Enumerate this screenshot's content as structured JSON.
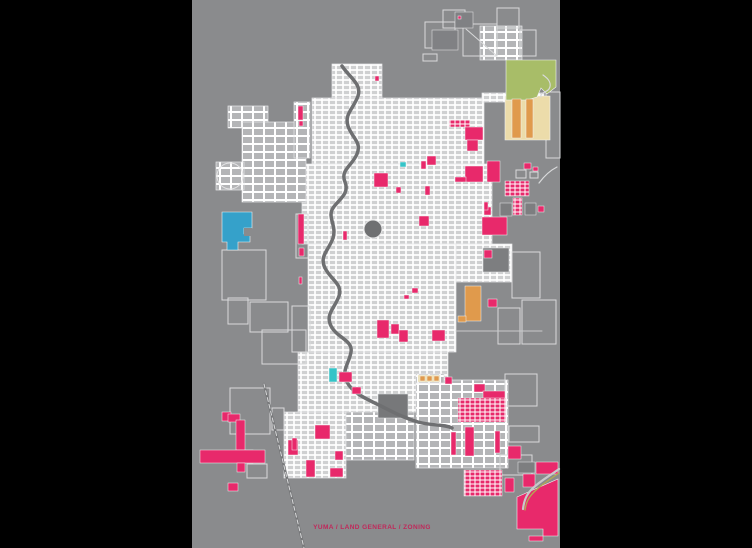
{
  "map": {
    "left": 192,
    "top": 0,
    "width": 368,
    "height": 548,
    "background": "#8a8b8d",
    "frame_color": "#000000",
    "caption": {
      "text": "YUMA / LAND GENERAL / ZONING",
      "x": 372,
      "y": 529,
      "size": 6.5,
      "color": "#c0285a"
    },
    "palette": {
      "pink": "#e8296b",
      "darkpink": "#8c1d47",
      "blue": "#35a1ca",
      "cyan": "#35c4c8",
      "green": "#a8bd68",
      "cream": "#ecdcaa",
      "orange": "#e09a4c",
      "khaki": "#b3ab50",
      "dark1": "#6f7072",
      "dark2": "#77787a",
      "dark3": "#7d7e80",
      "dark4": "#808184",
      "line": "#d9dadb",
      "river": "#6e6f71",
      "road": "#c9cacb",
      "bg": "#8a8b8d"
    },
    "fabric": [
      {
        "r": [
          332,
          64,
          50,
          36
        ],
        "s": "dense"
      },
      {
        "r": [
          312,
          98,
          172,
          66
        ],
        "s": "dense"
      },
      {
        "r": [
          482,
          93,
          62,
          9
        ],
        "s": "dense"
      },
      {
        "r": [
          302,
          164,
          190,
          80
        ],
        "s": "dense"
      },
      {
        "r": [
          456,
          244,
          56,
          38
        ],
        "s": "dense"
      },
      {
        "r": [
          308,
          244,
          148,
          108
        ],
        "s": "dense"
      },
      {
        "r": [
          298,
          352,
          150,
          60
        ],
        "s": "dense"
      },
      {
        "r": [
          284,
          412,
          62,
          66
        ],
        "s": "dense"
      },
      {
        "r": [
          346,
          412,
          68,
          48
        ],
        "s": "medium"
      },
      {
        "r": [
          416,
          380,
          92,
          88
        ],
        "s": "medium"
      },
      {
        "r": [
          480,
          26,
          42,
          34
        ],
        "s": "medium"
      },
      {
        "r": [
          228,
          106,
          40,
          22
        ],
        "s": "medium"
      },
      {
        "r": [
          242,
          122,
          64,
          80
        ],
        "s": "medium"
      },
      {
        "r": [
          216,
          162,
          28,
          28
        ],
        "s": "medium"
      },
      {
        "r": [
          416,
          374,
          28,
          9
        ],
        "s": "medium"
      },
      {
        "r": [
          294,
          102,
          16,
          56
        ],
        "s": "medium"
      }
    ],
    "outlines": [
      [
        425,
        22,
        30,
        26
      ],
      [
        443,
        10,
        22,
        18
      ],
      [
        463,
        24,
        34,
        32
      ],
      [
        497,
        8,
        22,
        20
      ],
      [
        520,
        30,
        16,
        26
      ],
      [
        423,
        54,
        14,
        7
      ],
      [
        222,
        250,
        44,
        50
      ],
      [
        228,
        298,
        20,
        26
      ],
      [
        250,
        302,
        38,
        30
      ],
      [
        262,
        330,
        44,
        34
      ],
      [
        292,
        306,
        18,
        46
      ],
      [
        230,
        388,
        40,
        46
      ],
      [
        272,
        408,
        12,
        22
      ],
      [
        247,
        464,
        20,
        14
      ],
      [
        512,
        252,
        28,
        46
      ],
      [
        498,
        308,
        22,
        36
      ],
      [
        522,
        300,
        34,
        44
      ],
      [
        546,
        92,
        14,
        66
      ],
      [
        505,
        374,
        32,
        32
      ],
      [
        509,
        426,
        30,
        16
      ],
      [
        500,
        455,
        32,
        20
      ],
      [
        296,
        214,
        12,
        44
      ],
      [
        516,
        170,
        10,
        8
      ],
      [
        530,
        172,
        8,
        6
      ]
    ],
    "darks": [
      {
        "r": [
          378,
          394,
          30,
          24
        ],
        "c": "dark2"
      },
      {
        "r": [
          483,
          248,
          26,
          24
        ],
        "c": "dark3"
      },
      {
        "r": [
          518,
          462,
          17,
          11
        ],
        "c": "dark3"
      },
      {
        "r": [
          432,
          30,
          26,
          20
        ],
        "c": "dark4"
      },
      {
        "r": [
          455,
          12,
          18,
          16
        ],
        "c": "dark4"
      },
      {
        "r": [
          500,
          203,
          12,
          13
        ],
        "c": "dark3"
      },
      {
        "r": [
          525,
          203,
          11,
          12
        ],
        "c": "dark3"
      },
      {
        "r": [
          245,
          450,
          8,
          13
        ],
        "c": "darkpink"
      }
    ],
    "circles": [
      {
        "c": [
          373,
          229,
          9
        ],
        "fill": "dark1"
      },
      {
        "c": [
          230,
          176,
          13
        ],
        "fill": "none"
      }
    ],
    "polygons": [
      {
        "p": "505,96 550,96 550,140 505,140",
        "c": "cream"
      },
      {
        "p": "506,60 556,60 556,87 547,94 541,88 537,97 527,100 506,100",
        "c": "green"
      },
      {
        "p": "222,212 252,212 252,228 244,228 244,234 250,234 250,242 238,242 238,250 227,250 227,242 222,242",
        "c": "blue"
      },
      {
        "p": "517,497 558,479 558,536 543,536 543,529 517,529",
        "c": "pink"
      }
    ],
    "parcels": [
      {
        "r": [
          298,
          106,
          5,
          14
        ],
        "c": "pink"
      },
      {
        "r": [
          299,
          121,
          4,
          5
        ],
        "c": "pink"
      },
      {
        "r": [
          449,
          120,
          21,
          7
        ],
        "c": "pinkgrid"
      },
      {
        "r": [
          465,
          127,
          18,
          13
        ],
        "c": "pink"
      },
      {
        "r": [
          467,
          140,
          11,
          11
        ],
        "c": "pink"
      },
      {
        "r": [
          427,
          156,
          9,
          9
        ],
        "c": "pink"
      },
      {
        "r": [
          421,
          161,
          5,
          8
        ],
        "c": "pink"
      },
      {
        "r": [
          465,
          166,
          18,
          16
        ],
        "c": "pink"
      },
      {
        "r": [
          487,
          161,
          13,
          21
        ],
        "c": "pink"
      },
      {
        "r": [
          524,
          163,
          7,
          6
        ],
        "c": "pink"
      },
      {
        "r": [
          533,
          167,
          5,
          4
        ],
        "c": "pink"
      },
      {
        "r": [
          455,
          177,
          11,
          5
        ],
        "c": "pink"
      },
      {
        "r": [
          374,
          173,
          14,
          14
        ],
        "c": "pink"
      },
      {
        "r": [
          396,
          187,
          5,
          6
        ],
        "c": "pink"
      },
      {
        "r": [
          425,
          186,
          5,
          9
        ],
        "c": "pink"
      },
      {
        "r": [
          375,
          76,
          4,
          5
        ],
        "c": "pink"
      },
      {
        "r": [
          458,
          16,
          3,
          3
        ],
        "c": "pink"
      },
      {
        "r": [
          505,
          181,
          24,
          15
        ],
        "c": "pinkgrid"
      },
      {
        "r": [
          513,
          198,
          9,
          17
        ],
        "c": "pinkgrid"
      },
      {
        "r": [
          419,
          216,
          10,
          10
        ],
        "c": "pink"
      },
      {
        "r": [
          484,
          207,
          7,
          8
        ],
        "c": "pink"
      },
      {
        "r": [
          482,
          217,
          25,
          18
        ],
        "c": "pink"
      },
      {
        "r": [
          538,
          206,
          6,
          6
        ],
        "c": "pink"
      },
      {
        "r": [
          484,
          202,
          4,
          8
        ],
        "c": "pink"
      },
      {
        "r": [
          484,
          250,
          8,
          8
        ],
        "c": "pink"
      },
      {
        "r": [
          298,
          214,
          6,
          30
        ],
        "c": "pink"
      },
      {
        "r": [
          299,
          248,
          5,
          8
        ],
        "c": "pink"
      },
      {
        "r": [
          299,
          277,
          3,
          7
        ],
        "c": "pink"
      },
      {
        "r": [
          343,
          231,
          4,
          9
        ],
        "c": "pink"
      },
      {
        "r": [
          488,
          299,
          9,
          8
        ],
        "c": "pink"
      },
      {
        "r": [
          465,
          286,
          16,
          35
        ],
        "c": "orange"
      },
      {
        "r": [
          458,
          316,
          8,
          6
        ],
        "c": "orange"
      },
      {
        "r": [
          512,
          99,
          9,
          39
        ],
        "c": "orange"
      },
      {
        "r": [
          526,
          99,
          7,
          39
        ],
        "c": "orange"
      },
      {
        "r": [
          418,
          375,
          22,
          7
        ],
        "c": "cream"
      },
      {
        "r": [
          420,
          376,
          5,
          5
        ],
        "c": "orange"
      },
      {
        "r": [
          427,
          376,
          5,
          5
        ],
        "c": "orange"
      },
      {
        "r": [
          434,
          376,
          5,
          5
        ],
        "c": "orange"
      },
      {
        "r": [
          377,
          320,
          12,
          18
        ],
        "c": "pink"
      },
      {
        "r": [
          391,
          324,
          8,
          10
        ],
        "c": "pink"
      },
      {
        "r": [
          399,
          330,
          9,
          12
        ],
        "c": "pink"
      },
      {
        "r": [
          432,
          330,
          13,
          11
        ],
        "c": "pink"
      },
      {
        "r": [
          412,
          288,
          6,
          5
        ],
        "c": "pink"
      },
      {
        "r": [
          404,
          295,
          5,
          4
        ],
        "c": "pink"
      },
      {
        "r": [
          400,
          162,
          6,
          5
        ],
        "c": "cyan"
      },
      {
        "r": [
          329,
          368,
          8,
          14
        ],
        "c": "cyan"
      },
      {
        "r": [
          339,
          372,
          13,
          10
        ],
        "c": "pink"
      },
      {
        "r": [
          352,
          387,
          9,
          7
        ],
        "c": "pink"
      },
      {
        "r": [
          445,
          377,
          7,
          7
        ],
        "c": "pink"
      },
      {
        "r": [
          474,
          384,
          11,
          8
        ],
        "c": "pink"
      },
      {
        "r": [
          483,
          391,
          22,
          13
        ],
        "c": "pink"
      },
      {
        "r": [
          458,
          398,
          48,
          24
        ],
        "c": "pinkgrid"
      },
      {
        "r": [
          451,
          432,
          5,
          23
        ],
        "c": "pink"
      },
      {
        "r": [
          465,
          427,
          9,
          29
        ],
        "c": "pink"
      },
      {
        "r": [
          495,
          431,
          5,
          22
        ],
        "c": "pink"
      },
      {
        "r": [
          508,
          446,
          13,
          13
        ],
        "c": "pink"
      },
      {
        "r": [
          464,
          470,
          38,
          26
        ],
        "c": "pinkgrid"
      },
      {
        "r": [
          222,
          412,
          9,
          9
        ],
        "c": "pink"
      },
      {
        "r": [
          228,
          414,
          12,
          8
        ],
        "c": "pink"
      },
      {
        "r": [
          236,
          420,
          9,
          30
        ],
        "c": "pink"
      },
      {
        "r": [
          200,
          450,
          65,
          13
        ],
        "c": "pink"
      },
      {
        "r": [
          237,
          463,
          8,
          9
        ],
        "c": "pink"
      },
      {
        "r": [
          288,
          440,
          10,
          15
        ],
        "c": "pink"
      },
      {
        "r": [
          228,
          483,
          10,
          8
        ],
        "c": "pink"
      },
      {
        "r": [
          315,
          425,
          15,
          14
        ],
        "c": "pink"
      },
      {
        "r": [
          292,
          438,
          5,
          12
        ],
        "c": "pink"
      },
      {
        "r": [
          335,
          451,
          8,
          9
        ],
        "c": "pink"
      },
      {
        "r": [
          306,
          460,
          9,
          17
        ],
        "c": "pink"
      },
      {
        "r": [
          330,
          468,
          13,
          9
        ],
        "c": "pink"
      },
      {
        "r": [
          505,
          478,
          9,
          14
        ],
        "c": "pink"
      },
      {
        "r": [
          536,
          462,
          22,
          12
        ],
        "c": "pink"
      },
      {
        "r": [
          523,
          474,
          12,
          13
        ],
        "c": "pink"
      },
      {
        "r": [
          529,
          536,
          14,
          5
        ],
        "c": "pink"
      },
      {
        "r": [
          244,
          228,
          8,
          8
        ],
        "c": "bg"
      }
    ],
    "paths": [
      {
        "d": "M342,66 C350,78 362,84 358,96 C354,108 344,114 348,126 C352,138 362,142 357,154 C352,166 340,170 345,182 C350,194 338,200 333,208 C327,217 337,226 333,238 C329,250 319,256 325,268 C331,280 343,284 339,296 C335,308 325,314 331,326 C337,338 353,340 351,352 C349,364 341,370 347,382 C353,394 369,400 381,406 C393,412 404,418 418,422 C432,426 444,424 452,428",
        "c": "river",
        "w": 3.5,
        "layer": "under"
      },
      {
        "d": "M539,183 C545,175 551,170 557,167",
        "c": "line",
        "w": 1.2,
        "layer": "under"
      },
      {
        "d": "M456,331 L542,331",
        "c": "road",
        "w": 1,
        "layer": "under"
      },
      {
        "d": "M466,29 L497,56",
        "c": "line",
        "w": 1,
        "layer": "under"
      },
      {
        "d": "M264,384 L304,548",
        "c": "dark2",
        "w": 2.5,
        "layer": "over"
      },
      {
        "d": "M264,384 L304,548",
        "c": "line",
        "w": 1,
        "dash": "4 3",
        "layer": "over"
      },
      {
        "d": "M559,469 C548,477 540,481 532,489 C526,495 524,501 523,509",
        "c": "road",
        "w": 2.2,
        "layer": "over"
      },
      {
        "d": "M559,473 C549,480 542,484 534,492 C528,498 526,503 525,510",
        "c": "khaki",
        "w": 1.3,
        "layer": "over"
      },
      {
        "d": "M543,75 C549,79 552,84 549,89 C546,93 540,92 541,97",
        "c": "line",
        "w": 1.2,
        "layer": "over"
      }
    ]
  }
}
